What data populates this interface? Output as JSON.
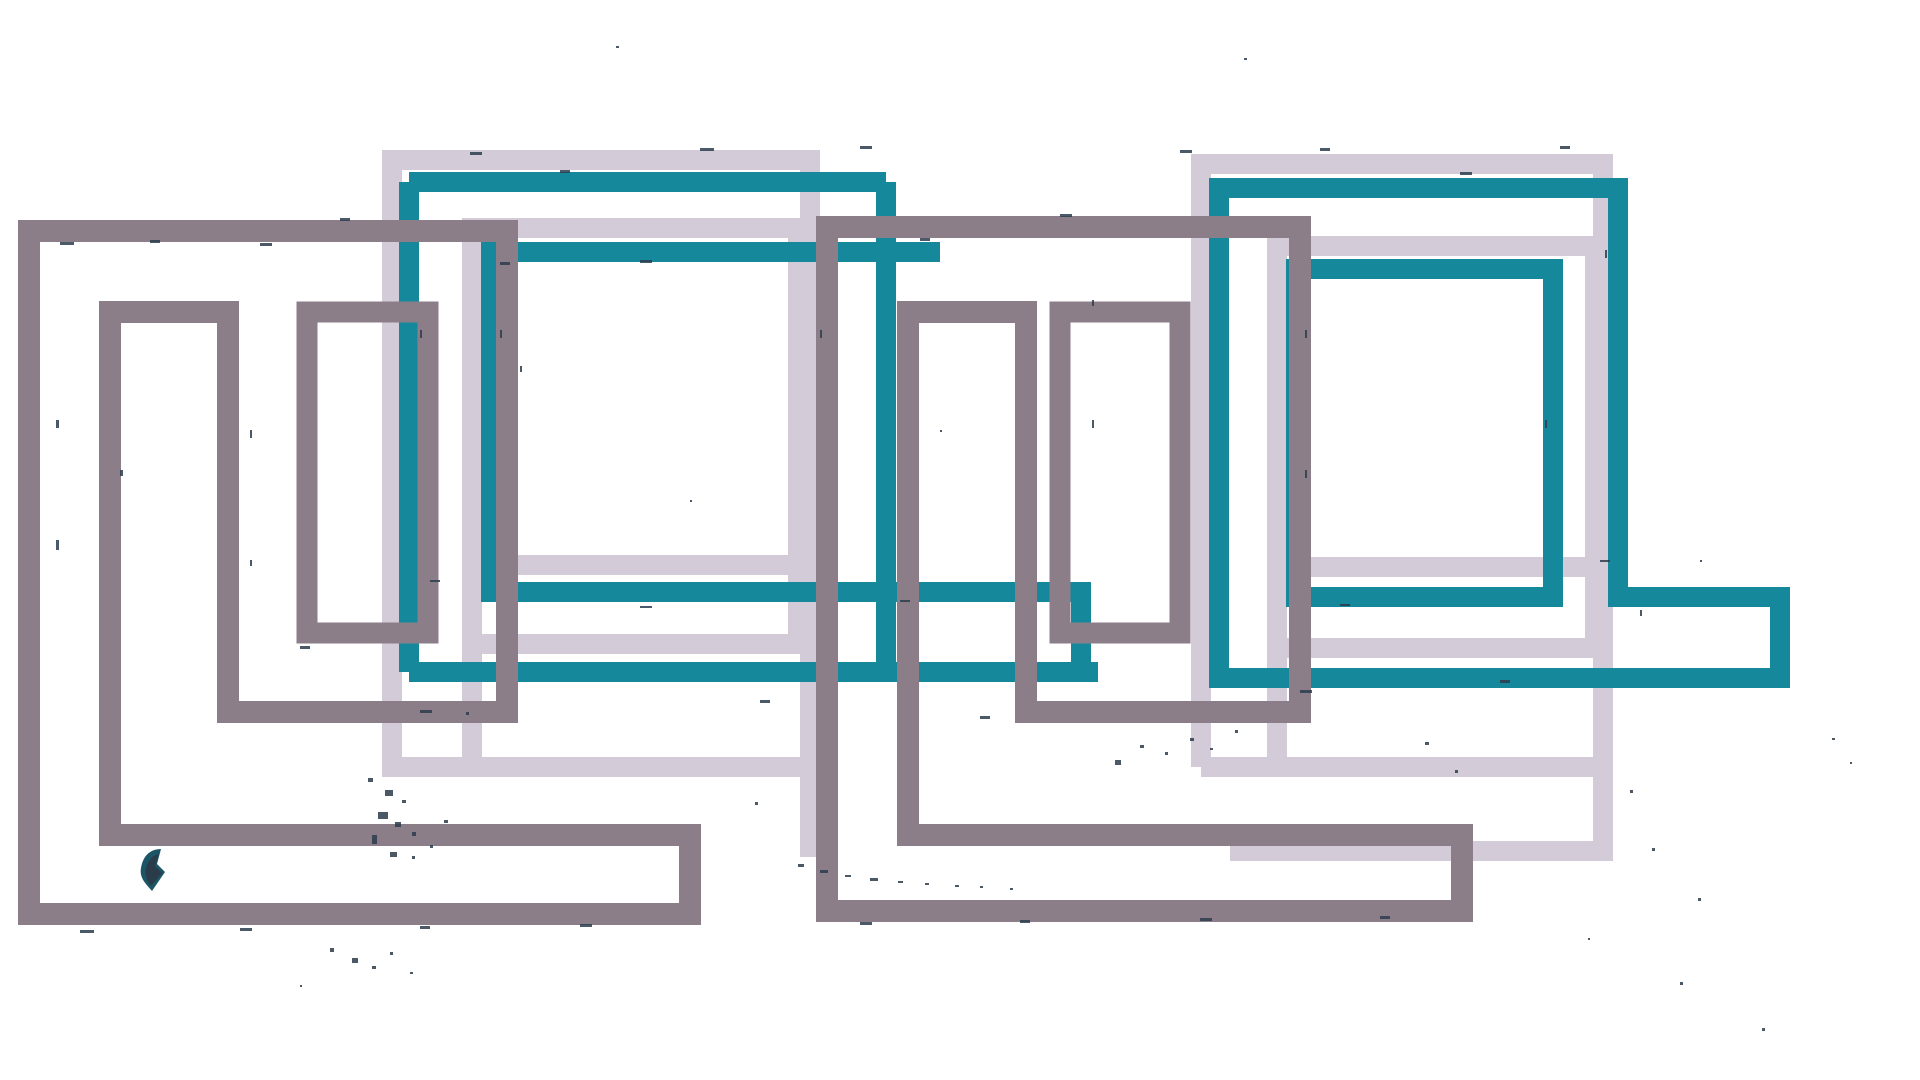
{
  "artwork": {
    "title": "abstract-overlapping-rectangles",
    "canvas": {
      "width": 1920,
      "height": 1080,
      "background": "#ffffff"
    },
    "palette": {
      "lavender": "#d3cbd8",
      "teal": "#15899b",
      "gray": "#8b7e88",
      "speckle": "#2c3d4d",
      "blob_teal": "#1c5666",
      "blob_dark": "#2a3b49"
    },
    "shapes": [
      {
        "name": "lavender-meander-left-outer",
        "d": "M810,857 V160 H392 V767 H820",
        "stroke": "#d3cbd8",
        "stroke_width": 20,
        "fill": "none"
      },
      {
        "name": "lavender-meander-left-inner",
        "d": "M472,762 V228 H798 V644 H472 M472,565 H810",
        "stroke": "#d3cbd8",
        "stroke_width": 20,
        "fill": "none"
      },
      {
        "name": "lavender-meander-right-outer",
        "d": "M1201,767 V164 H1603 V851 H1230 M1201,767 H1603",
        "stroke": "#d3cbd8",
        "stroke_width": 20,
        "fill": "none"
      },
      {
        "name": "lavender-meander-right-inner",
        "d": "M1277,762 V246 H1595 V648 H1277 M1277,567 H1605",
        "stroke": "#d3cbd8",
        "stroke_width": 20,
        "fill": "none"
      },
      {
        "name": "teal-meander-left-outer",
        "d": "M409,182 H886 M409,182 V672 M886,182 V672 M409,672 H1098",
        "stroke": "#15899b",
        "stroke_width": 20,
        "fill": "none"
      },
      {
        "name": "teal-meander-left-inner",
        "d": "M940,252 H491 V592 H1081 V678",
        "stroke": "#15899b",
        "stroke_width": 20,
        "fill": "none"
      },
      {
        "name": "teal-meander-right-outer",
        "d": "M1219,188 H1618 V597 H1780 V678 H1219 Z",
        "stroke": "#15899b",
        "stroke_width": 20,
        "fill": "none"
      },
      {
        "name": "teal-meander-right-inner",
        "d": "M1296,269 H1553 V597 H1296 Z",
        "stroke": "#15899b",
        "stroke_width": 20,
        "fill": "none"
      },
      {
        "name": "gray-meander-left",
        "d": "M29,231 H507 V712 H228 V312 H110 V835 H690 V914 H29 Z",
        "stroke": "#8b7e88",
        "stroke_width": 22,
        "fill": "none"
      },
      {
        "name": "gray-frame-left-small",
        "d": "M307,312 H428 V633 H307 Z",
        "stroke": "#8b7e88",
        "stroke_width": 21,
        "fill": "none"
      },
      {
        "name": "gray-meander-center",
        "d": "M827,227 H1300 V712 H1026 V312 H908 V835 H1462 V911 H827 Z",
        "stroke": "#8b7e88",
        "stroke_width": 22,
        "fill": "none"
      },
      {
        "name": "gray-frame-center-small",
        "d": "M1060,312 H1180 V633 H1060 Z",
        "stroke": "#8b7e88",
        "stroke_width": 21,
        "fill": "none"
      },
      {
        "name": "ink-blob-teal",
        "d": "M141,868 C143,856 150,849 161,849 L157,864 L165,872 L152,891 C146,884 139,878 141,868 Z",
        "stroke": "none",
        "stroke_width": 0,
        "fill": "#1c5666"
      },
      {
        "name": "ink-blob-dark",
        "d": "M146,868 C148,860 153,855 159,854 L155,866 L162,873 L151,886 C147,880 144,875 146,868 Z",
        "stroke": "none",
        "stroke_width": 0,
        "fill": "#2a3b49"
      }
    ],
    "speckle_color": "#2c3d4d",
    "speckles": [
      [
        368,
        778,
        5,
        4
      ],
      [
        385,
        790,
        8,
        6
      ],
      [
        402,
        800,
        4,
        3
      ],
      [
        378,
        812,
        10,
        7
      ],
      [
        395,
        822,
        6,
        5
      ],
      [
        412,
        832,
        4,
        4
      ],
      [
        430,
        845,
        3,
        3
      ],
      [
        372,
        835,
        5,
        9
      ],
      [
        390,
        852,
        7,
        5
      ],
      [
        412,
        856,
        3,
        3
      ],
      [
        444,
        820,
        4,
        3
      ],
      [
        466,
        712,
        3,
        3
      ],
      [
        798,
        864,
        6,
        3
      ],
      [
        820,
        870,
        8,
        3
      ],
      [
        845,
        875,
        6,
        2
      ],
      [
        870,
        878,
        8,
        3
      ],
      [
        898,
        881,
        5,
        2
      ],
      [
        925,
        883,
        4,
        2
      ],
      [
        955,
        885,
        4,
        2
      ],
      [
        980,
        886,
        3,
        2
      ],
      [
        1010,
        888,
        3,
        2
      ],
      [
        330,
        948,
        4,
        4
      ],
      [
        352,
        958,
        6,
        5
      ],
      [
        372,
        966,
        4,
        3
      ],
      [
        390,
        952,
        3,
        3
      ],
      [
        410,
        972,
        3,
        2
      ],
      [
        300,
        985,
        2,
        2
      ],
      [
        1115,
        760,
        6,
        5
      ],
      [
        1140,
        745,
        4,
        3
      ],
      [
        1165,
        752,
        3,
        3
      ],
      [
        1190,
        738,
        4,
        3
      ],
      [
        1210,
        748,
        3,
        2
      ],
      [
        1235,
        730,
        3,
        3
      ],
      [
        1425,
        742,
        4,
        3
      ],
      [
        1455,
        770,
        3,
        3
      ],
      [
        1630,
        790,
        3,
        3
      ],
      [
        1652,
        848,
        3,
        3
      ],
      [
        1698,
        898,
        3,
        3
      ],
      [
        1588,
        938,
        2,
        2
      ],
      [
        1680,
        982,
        3,
        3
      ],
      [
        1762,
        1028,
        3,
        3
      ],
      [
        1832,
        738,
        3,
        2
      ],
      [
        1850,
        762,
        2,
        2
      ],
      [
        616,
        46,
        3,
        2
      ],
      [
        1244,
        58,
        3,
        2
      ],
      [
        755,
        802,
        3,
        3
      ],
      [
        940,
        430,
        2,
        2
      ],
      [
        60,
        242,
        14,
        3
      ],
      [
        150,
        240,
        10,
        3
      ],
      [
        260,
        243,
        12,
        3
      ],
      [
        340,
        218,
        10,
        3
      ],
      [
        470,
        152,
        12,
        3
      ],
      [
        560,
        170,
        10,
        3
      ],
      [
        700,
        148,
        14,
        3
      ],
      [
        860,
        146,
        12,
        3
      ],
      [
        500,
        262,
        10,
        3
      ],
      [
        640,
        260,
        12,
        3
      ],
      [
        920,
        238,
        10,
        3
      ],
      [
        1060,
        214,
        12,
        3
      ],
      [
        1180,
        150,
        12,
        3
      ],
      [
        1320,
        148,
        10,
        3
      ],
      [
        1460,
        172,
        12,
        3
      ],
      [
        1560,
        146,
        10,
        3
      ],
      [
        80,
        930,
        14,
        3
      ],
      [
        240,
        928,
        12,
        3
      ],
      [
        420,
        926,
        10,
        3
      ],
      [
        580,
        924,
        12,
        3
      ],
      [
        860,
        922,
        12,
        3
      ],
      [
        1020,
        920,
        10,
        3
      ],
      [
        1200,
        918,
        12,
        3
      ],
      [
        1380,
        916,
        10,
        3
      ],
      [
        300,
        646,
        10,
        3
      ],
      [
        420,
        710,
        12,
        3
      ],
      [
        760,
        700,
        10,
        3
      ],
      [
        980,
        716,
        10,
        3
      ],
      [
        1300,
        690,
        12,
        3
      ],
      [
        1500,
        680,
        10,
        3
      ],
      [
        430,
        580,
        10,
        2
      ],
      [
        640,
        606,
        12,
        2
      ],
      [
        900,
        600,
        10,
        2
      ],
      [
        1340,
        604,
        10,
        2
      ],
      [
        1600,
        560,
        10,
        2
      ],
      [
        520,
        366,
        2,
        6
      ],
      [
        56,
        420,
        3,
        8
      ],
      [
        56,
        540,
        3,
        10
      ],
      [
        120,
        470,
        3,
        6
      ],
      [
        250,
        430,
        2,
        8
      ],
      [
        250,
        560,
        2,
        6
      ],
      [
        420,
        330,
        2,
        8
      ],
      [
        500,
        330,
        2,
        8
      ],
      [
        820,
        330,
        2,
        8
      ],
      [
        1305,
        330,
        2,
        8
      ],
      [
        1305,
        470,
        2,
        8
      ],
      [
        1605,
        250,
        2,
        8
      ],
      [
        1640,
        610,
        2,
        6
      ],
      [
        1545,
        420,
        2,
        8
      ],
      [
        1092,
        420,
        2,
        8
      ],
      [
        1092,
        300,
        2,
        6
      ],
      [
        690,
        500,
        2,
        2
      ],
      [
        1700,
        560,
        2,
        2
      ]
    ]
  }
}
